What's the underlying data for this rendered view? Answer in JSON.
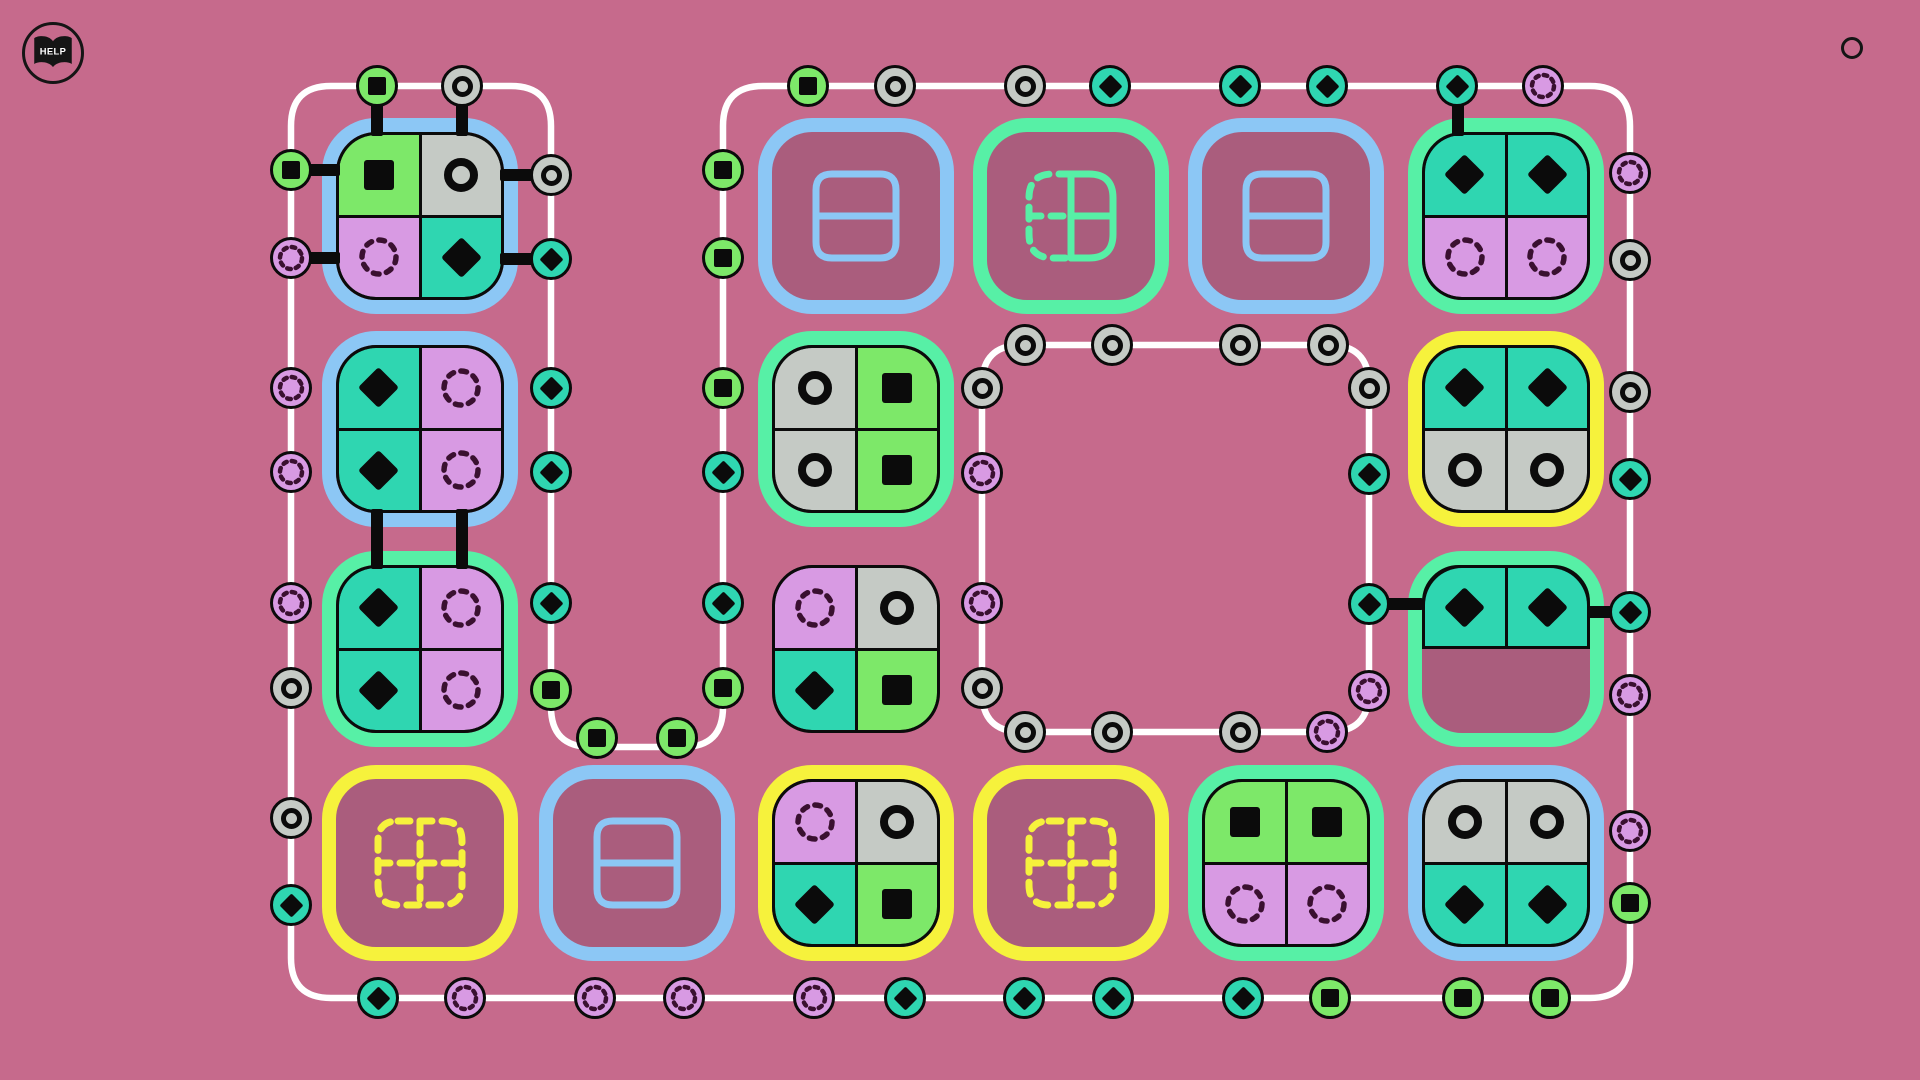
{
  "help_button": {
    "label": "HELP"
  },
  "palette": {
    "background": "#c66a8c",
    "slot_interior": "#aa5d7d",
    "track": "#ffffff",
    "glyph_black": "#0b0b0b",
    "dotted_glyph": "#3a1030",
    "borders": {
      "blue": "#8cc7f5",
      "green": "#57f0a6",
      "yellow": "#f6f23c"
    },
    "cells": {
      "green": "#7de869",
      "gray": "#c5cac5",
      "violet": "#d89ae3",
      "teal": "#2fd6b1"
    }
  },
  "board": {
    "track": {
      "outer": "M 291 126 Q 291 86 331 86 L 511 86 Q 551 86 551 126 L 551 707 Q 551 747 591 747 L 683 747 Q 723 747 723 707 L 723 126 Q 723 86 763 86 L 1590 86 Q 1630 86 1630 126 L 1630 958 Q 1630 998 1590 998 L 331 998 Q 291 998 291 958 Z",
      "inner": "M 1022 345 L 1329 345 Q 1369 345 1369 385 L 1369 692 Q 1369 732 1329 732 L 1022 732 Q 982 732 982 692 L 982 385 Q 982 345 1022 345 Z"
    },
    "tiles": [
      {
        "id": "r1c1",
        "x": 322,
        "y": 118,
        "border": "blue",
        "cells": [
          [
            "green",
            "square"
          ],
          [
            "gray",
            "ring"
          ],
          [
            "violet",
            "dotted"
          ],
          [
            "teal",
            "diamond"
          ]
        ]
      },
      {
        "id": "r1c3",
        "x": 758,
        "y": 118,
        "border": "blue",
        "empty_icon": "rows"
      },
      {
        "id": "r1c4",
        "x": 973,
        "y": 118,
        "border": "green",
        "empty_icon": "grid_half"
      },
      {
        "id": "r1c5",
        "x": 1188,
        "y": 118,
        "border": "blue",
        "empty_icon": "rows"
      },
      {
        "id": "r1c6",
        "x": 1408,
        "y": 118,
        "border": "green",
        "cells": [
          [
            "teal",
            "diamond"
          ],
          [
            "teal",
            "diamond"
          ],
          [
            "violet",
            "dotted"
          ],
          [
            "violet",
            "dotted"
          ]
        ]
      },
      {
        "id": "r2c1",
        "x": 322,
        "y": 331,
        "border": "blue",
        "cells": [
          [
            "teal",
            "diamond"
          ],
          [
            "violet",
            "dotted"
          ],
          [
            "teal",
            "diamond"
          ],
          [
            "violet",
            "dotted"
          ]
        ]
      },
      {
        "id": "r2c3",
        "x": 758,
        "y": 331,
        "border": "green",
        "cells": [
          [
            "gray",
            "ring"
          ],
          [
            "green",
            "square"
          ],
          [
            "gray",
            "ring"
          ],
          [
            "green",
            "square"
          ]
        ]
      },
      {
        "id": "r2c6",
        "x": 1408,
        "y": 331,
        "border": "yellow",
        "cells": [
          [
            "teal",
            "diamond"
          ],
          [
            "teal",
            "diamond"
          ],
          [
            "gray",
            "ring"
          ],
          [
            "gray",
            "ring"
          ]
        ]
      },
      {
        "id": "r3c1",
        "x": 322,
        "y": 551,
        "border": "green",
        "cells": [
          [
            "teal",
            "diamond"
          ],
          [
            "violet",
            "dotted"
          ],
          [
            "teal",
            "diamond"
          ],
          [
            "violet",
            "dotted"
          ]
        ]
      },
      {
        "id": "r3c3",
        "x": 772,
        "y": 565,
        "border": null,
        "cells": [
          [
            "violet",
            "dotted"
          ],
          [
            "gray",
            "ring"
          ],
          [
            "teal",
            "diamond"
          ],
          [
            "green",
            "square"
          ]
        ]
      },
      {
        "id": "r3c6",
        "x": 1408,
        "y": 551,
        "border": "green",
        "half": true,
        "cells": [
          [
            "teal",
            "diamond"
          ],
          [
            "teal",
            "diamond"
          ]
        ]
      },
      {
        "id": "r4c1",
        "x": 322,
        "y": 765,
        "border": "yellow",
        "empty_icon": "grid_dashed"
      },
      {
        "id": "r4c2",
        "x": 539,
        "y": 765,
        "border": "blue",
        "empty_icon": "rows"
      },
      {
        "id": "r4c3",
        "x": 758,
        "y": 765,
        "border": "yellow",
        "cells": [
          [
            "violet",
            "dotted"
          ],
          [
            "gray",
            "ring"
          ],
          [
            "teal",
            "diamond"
          ],
          [
            "green",
            "square"
          ]
        ]
      },
      {
        "id": "r4c4",
        "x": 973,
        "y": 765,
        "border": "yellow",
        "empty_icon": "grid_dashed"
      },
      {
        "id": "r4c5",
        "x": 1188,
        "y": 765,
        "border": "green",
        "cells": [
          [
            "green",
            "square"
          ],
          [
            "green",
            "square"
          ],
          [
            "violet",
            "dotted"
          ],
          [
            "violet",
            "dotted"
          ]
        ]
      },
      {
        "id": "r4c6",
        "x": 1408,
        "y": 765,
        "border": "blue",
        "cells": [
          [
            "gray",
            "ring"
          ],
          [
            "gray",
            "ring"
          ],
          [
            "teal",
            "diamond"
          ],
          [
            "teal",
            "diamond"
          ]
        ]
      }
    ],
    "links": [
      [
        371,
        92,
        12,
        44
      ],
      [
        456,
        92,
        12,
        44
      ],
      [
        296,
        164,
        44,
        12
      ],
      [
        296,
        252,
        44,
        12
      ],
      [
        500,
        169,
        45,
        12
      ],
      [
        500,
        253,
        45,
        12
      ],
      [
        371,
        509,
        12,
        60
      ],
      [
        456,
        509,
        12,
        60
      ],
      [
        1452,
        92,
        12,
        44
      ],
      [
        1371,
        598,
        52,
        12
      ],
      [
        1588,
        606,
        44,
        12
      ]
    ],
    "nodes": [
      [
        377,
        86,
        "green",
        "square"
      ],
      [
        462,
        86,
        "gray",
        "ring"
      ],
      [
        808,
        86,
        "green",
        "square"
      ],
      [
        895,
        86,
        "gray",
        "ring"
      ],
      [
        1025,
        86,
        "gray",
        "ring"
      ],
      [
        1110,
        86,
        "teal",
        "diamond"
      ],
      [
        1240,
        86,
        "teal",
        "diamond"
      ],
      [
        1327,
        86,
        "teal",
        "diamond"
      ],
      [
        1457,
        86,
        "teal",
        "diamond"
      ],
      [
        1543,
        86,
        "violet",
        "dotted"
      ],
      [
        291,
        170,
        "green",
        "square"
      ],
      [
        291,
        258,
        "violet",
        "dotted"
      ],
      [
        291,
        388,
        "violet",
        "dotted"
      ],
      [
        291,
        472,
        "violet",
        "dotted"
      ],
      [
        291,
        603,
        "violet",
        "dotted"
      ],
      [
        291,
        688,
        "gray",
        "ring"
      ],
      [
        291,
        818,
        "gray",
        "ring"
      ],
      [
        291,
        905,
        "teal",
        "diamond"
      ],
      [
        551,
        175,
        "gray",
        "ring"
      ],
      [
        551,
        259,
        "teal",
        "diamond"
      ],
      [
        551,
        388,
        "teal",
        "diamond"
      ],
      [
        551,
        472,
        "teal",
        "diamond"
      ],
      [
        551,
        603,
        "teal",
        "diamond"
      ],
      [
        551,
        690,
        "green",
        "square"
      ],
      [
        597,
        738,
        "green",
        "square"
      ],
      [
        677,
        738,
        "green",
        "square"
      ],
      [
        723,
        170,
        "green",
        "square"
      ],
      [
        723,
        258,
        "green",
        "square"
      ],
      [
        723,
        388,
        "green",
        "square"
      ],
      [
        723,
        472,
        "teal",
        "diamond"
      ],
      [
        723,
        603,
        "teal",
        "diamond"
      ],
      [
        723,
        688,
        "green",
        "square"
      ],
      [
        1630,
        173,
        "violet",
        "dotted"
      ],
      [
        1630,
        260,
        "gray",
        "ring"
      ],
      [
        1630,
        392,
        "gray",
        "ring"
      ],
      [
        1630,
        479,
        "teal",
        "diamond"
      ],
      [
        1630,
        612,
        "teal",
        "diamond"
      ],
      [
        1630,
        695,
        "violet",
        "dotted"
      ],
      [
        1630,
        831,
        "violet",
        "dotted"
      ],
      [
        1630,
        903,
        "green",
        "square"
      ],
      [
        378,
        998,
        "teal",
        "diamond"
      ],
      [
        465,
        998,
        "violet",
        "dotted"
      ],
      [
        595,
        998,
        "violet",
        "dotted"
      ],
      [
        684,
        998,
        "violet",
        "dotted"
      ],
      [
        814,
        998,
        "violet",
        "dotted"
      ],
      [
        905,
        998,
        "teal",
        "diamond"
      ],
      [
        1024,
        998,
        "teal",
        "diamond"
      ],
      [
        1113,
        998,
        "teal",
        "diamond"
      ],
      [
        1243,
        998,
        "teal",
        "diamond"
      ],
      [
        1330,
        998,
        "green",
        "square"
      ],
      [
        1463,
        998,
        "green",
        "square"
      ],
      [
        1550,
        998,
        "green",
        "square"
      ],
      [
        1025,
        345,
        "gray",
        "ring"
      ],
      [
        1112,
        345,
        "gray",
        "ring"
      ],
      [
        1240,
        345,
        "gray",
        "ring"
      ],
      [
        1328,
        345,
        "gray",
        "ring"
      ],
      [
        1369,
        388,
        "gray",
        "ring"
      ],
      [
        1369,
        474,
        "teal",
        "diamond"
      ],
      [
        1369,
        604,
        "teal",
        "diamond"
      ],
      [
        1369,
        691,
        "violet",
        "dotted"
      ],
      [
        1025,
        732,
        "gray",
        "ring"
      ],
      [
        1112,
        732,
        "gray",
        "ring"
      ],
      [
        1240,
        732,
        "gray",
        "ring"
      ],
      [
        1327,
        732,
        "violet",
        "dotted"
      ],
      [
        982,
        388,
        "gray",
        "ring"
      ],
      [
        982,
        473,
        "violet",
        "dotted"
      ],
      [
        982,
        603,
        "violet",
        "dotted"
      ],
      [
        982,
        688,
        "gray",
        "ring"
      ]
    ]
  }
}
